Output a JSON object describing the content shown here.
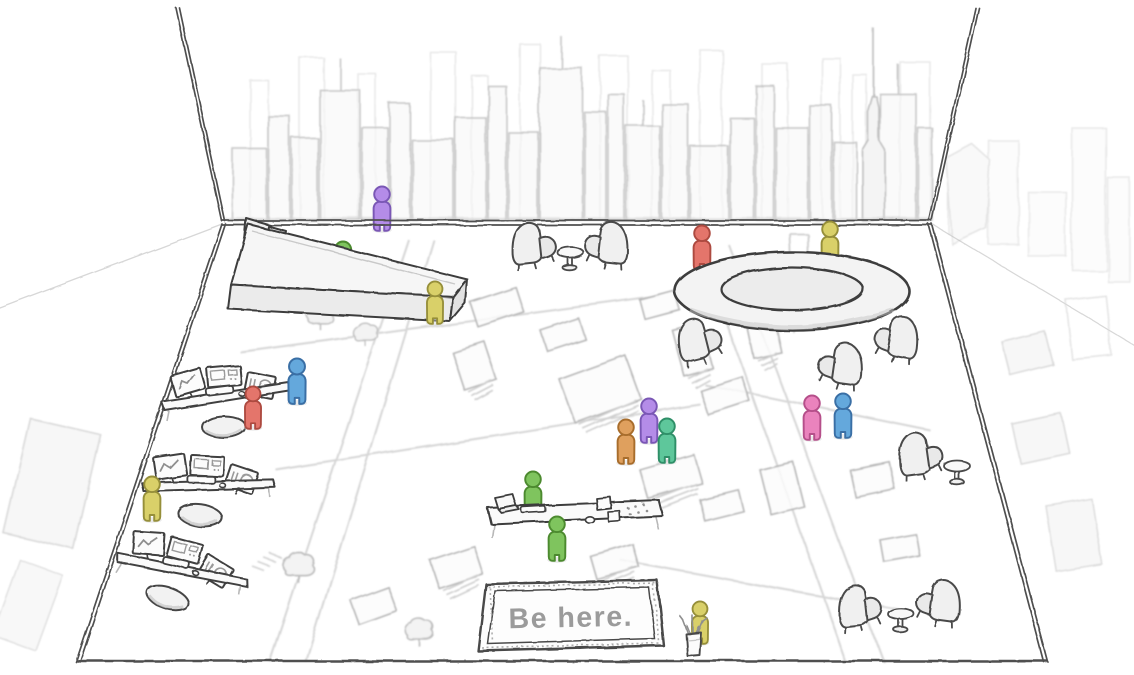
{
  "sign": {
    "text": "Be here.",
    "color": "#9b9b9b"
  },
  "palette": {
    "paper": "#ffffff",
    "ink_dark": "#404040",
    "ink_mid": "#8f8f8f",
    "ink_light": "#c4c4c4",
    "ink_faint": "#dcdcdc"
  },
  "monitor_glyphs": [
    "line-chart",
    "app-windows",
    "gauge-dial"
  ],
  "inventory": {
    "people": 16,
    "workstation_desks": 3,
    "monitors_per_desk": 3,
    "stools": 3,
    "armchairs": 8,
    "side_tables": 3,
    "ring_conference_table": 1,
    "reception_counter": 1,
    "collaboration_desk": 1,
    "laptop": 1,
    "pencil_cup": 1,
    "welcome_sign": 1
  },
  "figures": [
    {
      "name": "person-purple-reception",
      "layer": "behind-sill",
      "fill": "#b48ce8",
      "stroke": "#7a57b5",
      "x": 382,
      "y": 231,
      "h": 46
    },
    {
      "name": "person-green-reception",
      "layer": "behind-counter",
      "fill": "#7fc45e",
      "stroke": "#4c8a2f",
      "x": 343,
      "y": 288,
      "h": 48
    },
    {
      "name": "person-red-ring-table",
      "layer": "behind-ring",
      "fill": "#e4756b",
      "stroke": "#ad4a40",
      "x": 702,
      "y": 270,
      "h": 46
    },
    {
      "name": "person-yellow-ring-table",
      "layer": "behind-ring",
      "fill": "#d9d069",
      "stroke": "#968f3a",
      "x": 830,
      "y": 266,
      "h": 46
    },
    {
      "name": "person-green-collab-desk-back",
      "layer": "behind-collab",
      "fill": "#7fc45e",
      "stroke": "#4c8a2f",
      "x": 533,
      "y": 516,
      "h": 46
    },
    {
      "name": "person-yellow-reception-end",
      "layer": "front",
      "fill": "#d9d069",
      "stroke": "#968f3a",
      "x": 435,
      "y": 324,
      "h": 44
    },
    {
      "name": "person-blue-workstation-1",
      "layer": "front",
      "fill": "#64a8dc",
      "stroke": "#3a6fa5",
      "x": 297,
      "y": 404,
      "h": 47
    },
    {
      "name": "person-red-workstation-1",
      "layer": "front",
      "fill": "#e4756b",
      "stroke": "#ad4a40",
      "x": 253,
      "y": 429,
      "h": 44
    },
    {
      "name": "person-yellow-workstation-2",
      "layer": "front",
      "fill": "#d9d069",
      "stroke": "#968f3a",
      "x": 152,
      "y": 521,
      "h": 46
    },
    {
      "name": "person-purple-group",
      "layer": "front",
      "fill": "#b48ce8",
      "stroke": "#7a57b5",
      "x": 649,
      "y": 443,
      "h": 46
    },
    {
      "name": "person-teal-group",
      "layer": "front",
      "fill": "#5ec79b",
      "stroke": "#2f8f68",
      "x": 667,
      "y": 463,
      "h": 46
    },
    {
      "name": "person-orange-group",
      "layer": "front",
      "fill": "#dfa05e",
      "stroke": "#a86d2c",
      "x": 626,
      "y": 464,
      "h": 46
    },
    {
      "name": "person-pink-pair",
      "layer": "front",
      "fill": "#ea83bd",
      "stroke": "#b54f8a",
      "x": 812,
      "y": 440,
      "h": 46
    },
    {
      "name": "person-blue-pair",
      "layer": "front",
      "fill": "#64a8dc",
      "stroke": "#3a6fa5",
      "x": 843,
      "y": 438,
      "h": 46
    },
    {
      "name": "person-green-collab-desk-front",
      "layer": "front",
      "fill": "#7fc45e",
      "stroke": "#4c8a2f",
      "x": 557,
      "y": 561,
      "h": 46
    },
    {
      "name": "person-yellow-sign",
      "layer": "front",
      "fill": "#d9d069",
      "stroke": "#968f3a",
      "x": 700,
      "y": 644,
      "h": 44
    }
  ]
}
